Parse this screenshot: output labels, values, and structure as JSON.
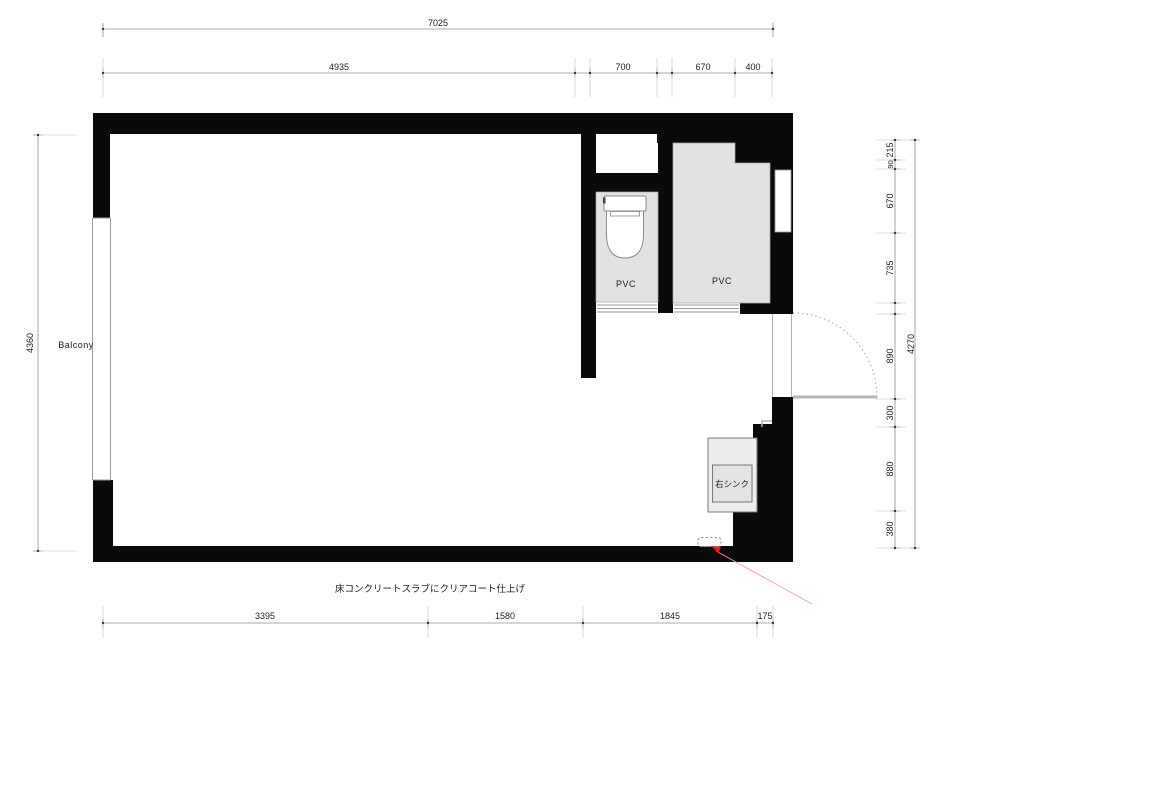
{
  "plan": {
    "balcony": "Balcony",
    "toilet_room_material": "PVC",
    "shower_room_material": "PVC",
    "sink": "右シンク",
    "floor_note": "床コンクリートスラブにクリアコート仕上げ"
  },
  "dimensions": {
    "top_overall": "7025",
    "top_segments": [
      "4935",
      "700",
      "670",
      "400"
    ],
    "bottom_segments": [
      "3395",
      "1580",
      "1845",
      "175"
    ],
    "left_overall": "4360",
    "right_overall": "4270",
    "right_segments": [
      "215",
      "90",
      "670",
      "735",
      "890",
      "300",
      "880",
      "380"
    ]
  },
  "colors": {
    "wall": "#0a0a0a",
    "room_fill": "#e2e2e2",
    "sink_fill": "#ededed",
    "dim_line": "#8f8f8f",
    "leader_red": "#e87a7a",
    "arrow_red": "#dd1f1f"
  }
}
